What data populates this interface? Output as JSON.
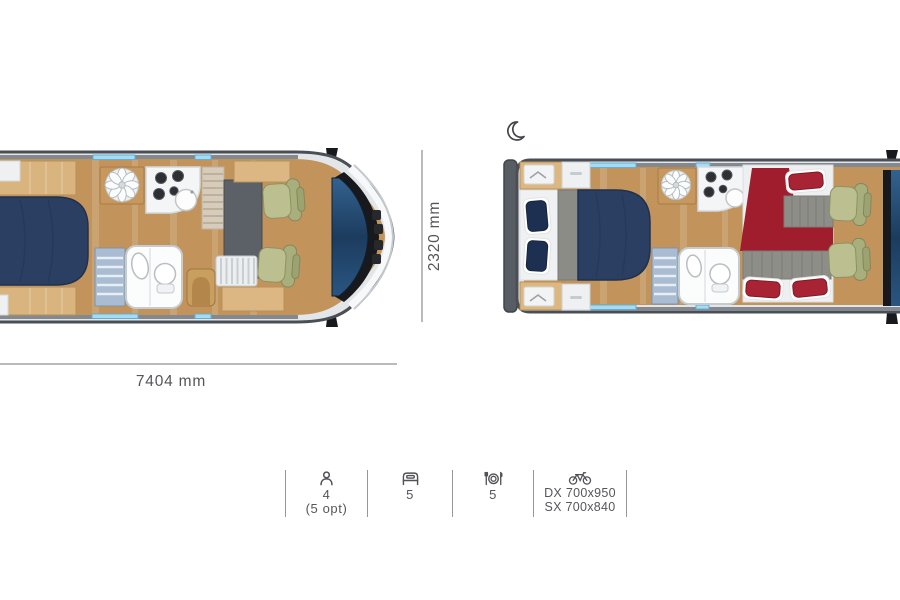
{
  "diagram": {
    "subject": "motorhome-floorplan",
    "views": [
      "day-layout",
      "night-layout"
    ],
    "night_view_icon": "moon-icon"
  },
  "dimensions": {
    "width": "2320 mm",
    "length": "7404 mm"
  },
  "specs": [
    {
      "name": "travel-seats",
      "icon": "person-icon",
      "lines": [
        "4",
        "(5 opt)"
      ]
    },
    {
      "name": "sleeping-berths",
      "icon": "bed-icon",
      "lines": [
        "5"
      ]
    },
    {
      "name": "dining-places",
      "icon": "dining-icon",
      "lines": [
        "5"
      ]
    },
    {
      "name": "garage-bike-rack",
      "icon": "bicycle-icon",
      "lines": [
        "DX 700x950",
        "SX 700x840"
      ]
    }
  ],
  "colors": {
    "background": "#ffffff",
    "text": "#55565a",
    "dimension_line": "#b9babc",
    "separator": "#96979a",
    "body_outline": "#4a4f55",
    "wood_floor": "#c2945c",
    "wood_furniture": "#dcb67f",
    "bed_navy": "#2b3f63",
    "bed_red": "#9f1d2c",
    "fabric_gray": "#8e8e88",
    "seat_olive": "#bcc091",
    "glass_blue": "#2a567f",
    "skylight_blue": "#a6dbf2"
  }
}
